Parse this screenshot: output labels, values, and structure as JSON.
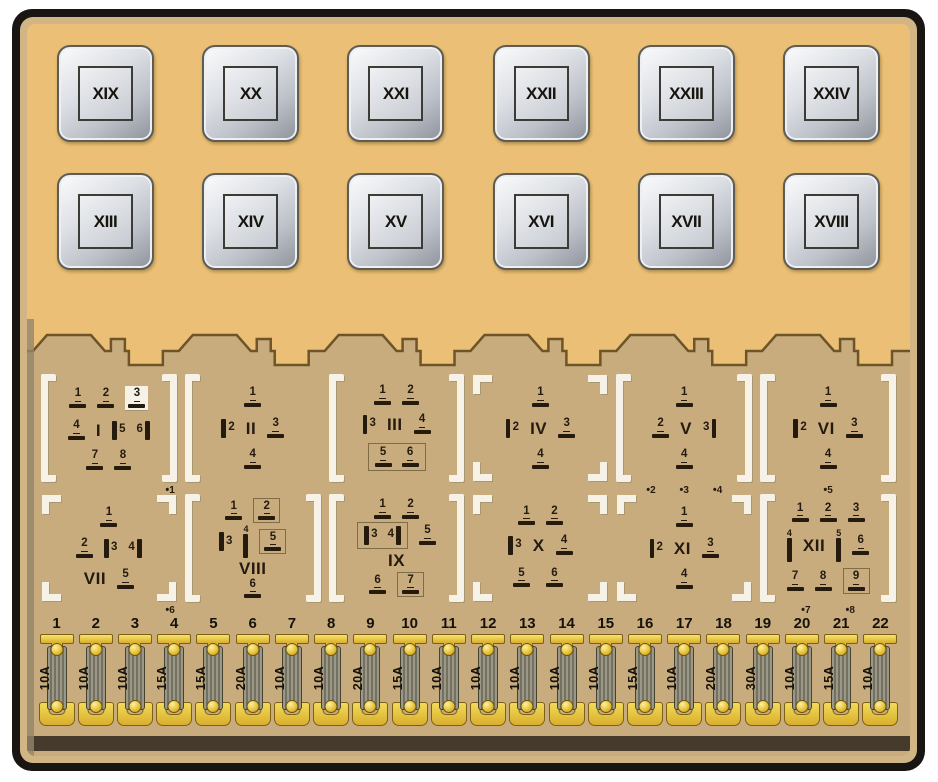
{
  "diagram_title": "Fuse and relay panel diagram",
  "colors": {
    "panel_top": "#ebc076",
    "panel_lower": "#c8ac7e",
    "rim": "#d2b584",
    "border": "#181512",
    "edge_line": "#6d5429",
    "bracket_white": "#f7f2e7",
    "ink": "#241a0e",
    "fuse_yellow": "#e8c43a",
    "relay_silver": "#c9ccd4"
  },
  "relay_rows": [
    [
      "XIX",
      "XX",
      "XXI",
      "XXII",
      "XXIII",
      "XXIV"
    ],
    [
      "XIII",
      "XIV",
      "XV",
      "XVI",
      "XVII",
      "XVIII"
    ]
  ],
  "connector_rows": [
    [
      {
        "label": "I",
        "bracket": "full",
        "dots": [
          "1"
        ],
        "dots_align": "right",
        "rows": [
          [
            {
              "t": "h",
              "n": "1"
            },
            {
              "t": "h",
              "n": "2"
            },
            {
              "t": "h",
              "n": "3",
              "plate": true
            }
          ],
          [
            {
              "t": "h",
              "n": "4"
            },
            {
              "t": "label"
            },
            {
              "t": "vl",
              "n": "5"
            },
            {
              "t": "vr",
              "n": "6"
            }
          ],
          [
            {
              "t": "h",
              "n": "7"
            },
            {
              "t": "h",
              "n": "8"
            }
          ]
        ]
      },
      {
        "label": "II",
        "bracket": "left",
        "rows": [
          [
            {
              "t": "h",
              "n": "1"
            }
          ],
          [
            {
              "t": "vl",
              "n": "2"
            },
            {
              "t": "label"
            },
            {
              "t": "h",
              "n": "3"
            }
          ],
          [
            {
              "t": "h",
              "n": "4"
            }
          ]
        ]
      },
      {
        "label": "III",
        "bracket": "full",
        "rows": [
          [
            {
              "t": "h",
              "n": "1"
            },
            {
              "t": "h",
              "n": "2"
            }
          ],
          [
            {
              "t": "vl",
              "n": "3"
            },
            {
              "t": "label"
            },
            {
              "t": "h",
              "n": "4"
            }
          ],
          [
            {
              "t": "group-box",
              "pins": [
                {
                  "t": "h",
                  "n": "5"
                },
                {
                  "t": "h",
                  "n": "6"
                }
              ]
            }
          ]
        ]
      },
      {
        "label": "IV",
        "bracket": "corner",
        "rows": [
          [
            {
              "t": "h",
              "n": "1"
            }
          ],
          [
            {
              "t": "vl",
              "n": "2"
            },
            {
              "t": "label"
            },
            {
              "t": "h",
              "n": "3"
            }
          ],
          [
            {
              "t": "h",
              "n": "4"
            }
          ]
        ]
      },
      {
        "label": "V",
        "bracket": "full",
        "dots": [
          "2",
          "3",
          "4"
        ],
        "rows": [
          [
            {
              "t": "h",
              "n": "1"
            }
          ],
          [
            {
              "t": "h",
              "n": "2"
            },
            {
              "t": "label"
            },
            {
              "t": "vr",
              "n": "3"
            }
          ],
          [
            {
              "t": "h",
              "n": "4"
            }
          ]
        ]
      },
      {
        "label": "VI",
        "bracket": "full",
        "dots": [
          "5"
        ],
        "rows": [
          [
            {
              "t": "h",
              "n": "1"
            }
          ],
          [
            {
              "t": "vl",
              "n": "2"
            },
            {
              "t": "label"
            },
            {
              "t": "h",
              "n": "3"
            }
          ],
          [
            {
              "t": "h",
              "n": "4"
            }
          ]
        ]
      }
    ],
    [
      {
        "label": "VII",
        "bracket": "corner",
        "dots": [
          "6"
        ],
        "dots_align": "right",
        "rows": [
          [
            {
              "t": "h",
              "n": "1"
            }
          ],
          [
            {
              "t": "h",
              "n": "2"
            },
            {
              "t": "vl",
              "n": "3"
            },
            {
              "t": "vr",
              "n": "4"
            }
          ],
          [
            {
              "t": "label"
            },
            {
              "t": "h",
              "n": "5"
            }
          ]
        ]
      },
      {
        "label": "VIII",
        "bracket": "full",
        "rows": [
          [
            {
              "t": "h",
              "n": "1"
            },
            {
              "t": "h",
              "n": "2",
              "box": true
            }
          ],
          [
            {
              "t": "vl",
              "n": "3"
            },
            {
              "t": "tall",
              "n": "4"
            },
            {
              "t": "h",
              "n": "5",
              "box": true
            }
          ],
          [
            {
              "t": "label"
            }
          ],
          [
            {
              "t": "h",
              "n": "6"
            }
          ]
        ]
      },
      {
        "label": "IX",
        "bracket": "full",
        "rows": [
          [
            {
              "t": "h",
              "n": "1"
            },
            {
              "t": "h",
              "n": "2"
            }
          ],
          [
            {
              "t": "group-box",
              "pins": [
                {
                  "t": "vl",
                  "n": "3"
                },
                {
                  "t": "vr",
                  "n": "4"
                }
              ]
            },
            {
              "t": "h",
              "n": "5"
            }
          ],
          [
            {
              "t": "label"
            }
          ],
          [
            {
              "t": "h",
              "n": "6"
            },
            {
              "t": "h",
              "n": "7",
              "box": true
            }
          ]
        ]
      },
      {
        "label": "X",
        "bracket": "corner",
        "rows": [
          [
            {
              "t": "h",
              "n": "1"
            },
            {
              "t": "h",
              "n": "2"
            }
          ],
          [
            {
              "t": "vl",
              "n": "3"
            },
            {
              "t": "label"
            },
            {
              "t": "h",
              "n": "4"
            }
          ],
          [
            {
              "t": "h",
              "n": "5"
            },
            {
              "t": "h",
              "n": "6",
              "box": "light"
            }
          ]
        ]
      },
      {
        "label": "XI",
        "bracket": "corner",
        "rows": [
          [
            {
              "t": "h",
              "n": "1"
            }
          ],
          [
            {
              "t": "vl",
              "n": "2"
            },
            {
              "t": "label"
            },
            {
              "t": "h",
              "n": "3"
            }
          ],
          [
            {
              "t": "h",
              "n": "4"
            }
          ]
        ]
      },
      {
        "label": "XII",
        "bracket": "full",
        "dots": [
          "7",
          "8"
        ],
        "rows": [
          [
            {
              "t": "h",
              "n": "1"
            },
            {
              "t": "h",
              "n": "2"
            },
            {
              "t": "h",
              "n": "3"
            }
          ],
          [
            {
              "t": "tall",
              "n": "4"
            },
            {
              "t": "label"
            },
            {
              "t": "tall",
              "n": "5"
            },
            {
              "t": "h",
              "n": "6"
            }
          ],
          [
            {
              "t": "h",
              "n": "7"
            },
            {
              "t": "h",
              "n": "8"
            },
            {
              "t": "h",
              "n": "9",
              "box": true
            }
          ]
        ]
      }
    ]
  ],
  "fuses": [
    {
      "n": "1",
      "amp": "10A"
    },
    {
      "n": "2",
      "amp": "10A"
    },
    {
      "n": "3",
      "amp": "10A"
    },
    {
      "n": "4",
      "amp": "15A"
    },
    {
      "n": "5",
      "amp": "15A"
    },
    {
      "n": "6",
      "amp": "20A"
    },
    {
      "n": "7",
      "amp": "10A"
    },
    {
      "n": "8",
      "amp": "10A"
    },
    {
      "n": "9",
      "amp": "20A"
    },
    {
      "n": "10",
      "amp": "15A"
    },
    {
      "n": "11",
      "amp": "10A"
    },
    {
      "n": "12",
      "amp": "10A"
    },
    {
      "n": "13",
      "amp": "10A"
    },
    {
      "n": "14",
      "amp": "10A"
    },
    {
      "n": "15",
      "amp": "10A"
    },
    {
      "n": "16",
      "amp": "15A"
    },
    {
      "n": "17",
      "amp": "10A"
    },
    {
      "n": "18",
      "amp": "20A"
    },
    {
      "n": "19",
      "amp": "30A"
    },
    {
      "n": "20",
      "amp": "10A"
    },
    {
      "n": "21",
      "amp": "15A"
    },
    {
      "n": "22",
      "amp": "10A"
    }
  ]
}
